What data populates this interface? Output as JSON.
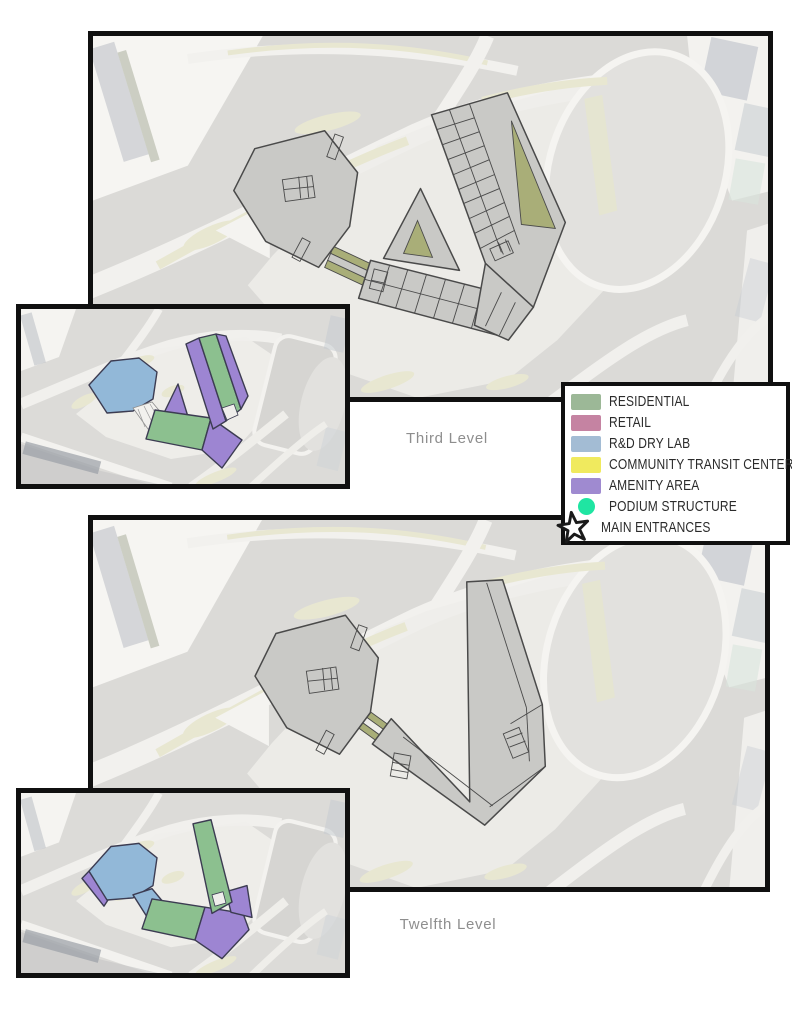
{
  "legend": {
    "items": [
      {
        "label": "RESIDENTIAL",
        "color": "#9cb897",
        "icon": "swatch"
      },
      {
        "label": "RETAIL",
        "color": "#c583a2",
        "icon": "swatch"
      },
      {
        "label": "R&D DRY LAB",
        "color": "#a3bcd4",
        "icon": "swatch"
      },
      {
        "label": "COMMUNITY TRANSIT CENTER",
        "color": "#f0ea5e",
        "icon": "swatch"
      },
      {
        "label": "AMENITY AREA",
        "color": "#9f8ad0",
        "icon": "swatch"
      },
      {
        "label": "PODIUM STRUCTURE",
        "color": "#1fe5a2",
        "icon": "circle"
      },
      {
        "label": "MAIN ENTRANCES",
        "color": "#1a1a1a",
        "icon": "star"
      }
    ]
  },
  "levels": {
    "third": "Third Level",
    "twelfth": "Twelfth Level"
  },
  "colors": {
    "building": "#c9c9c6",
    "outline": "#4a4a4a",
    "olive": "#a9ae78",
    "plan_green": "#8cc08f",
    "plan_blue": "#92b8d8",
    "plan_purple": "#9d85d2",
    "label_gray": "#8e8e8e"
  }
}
